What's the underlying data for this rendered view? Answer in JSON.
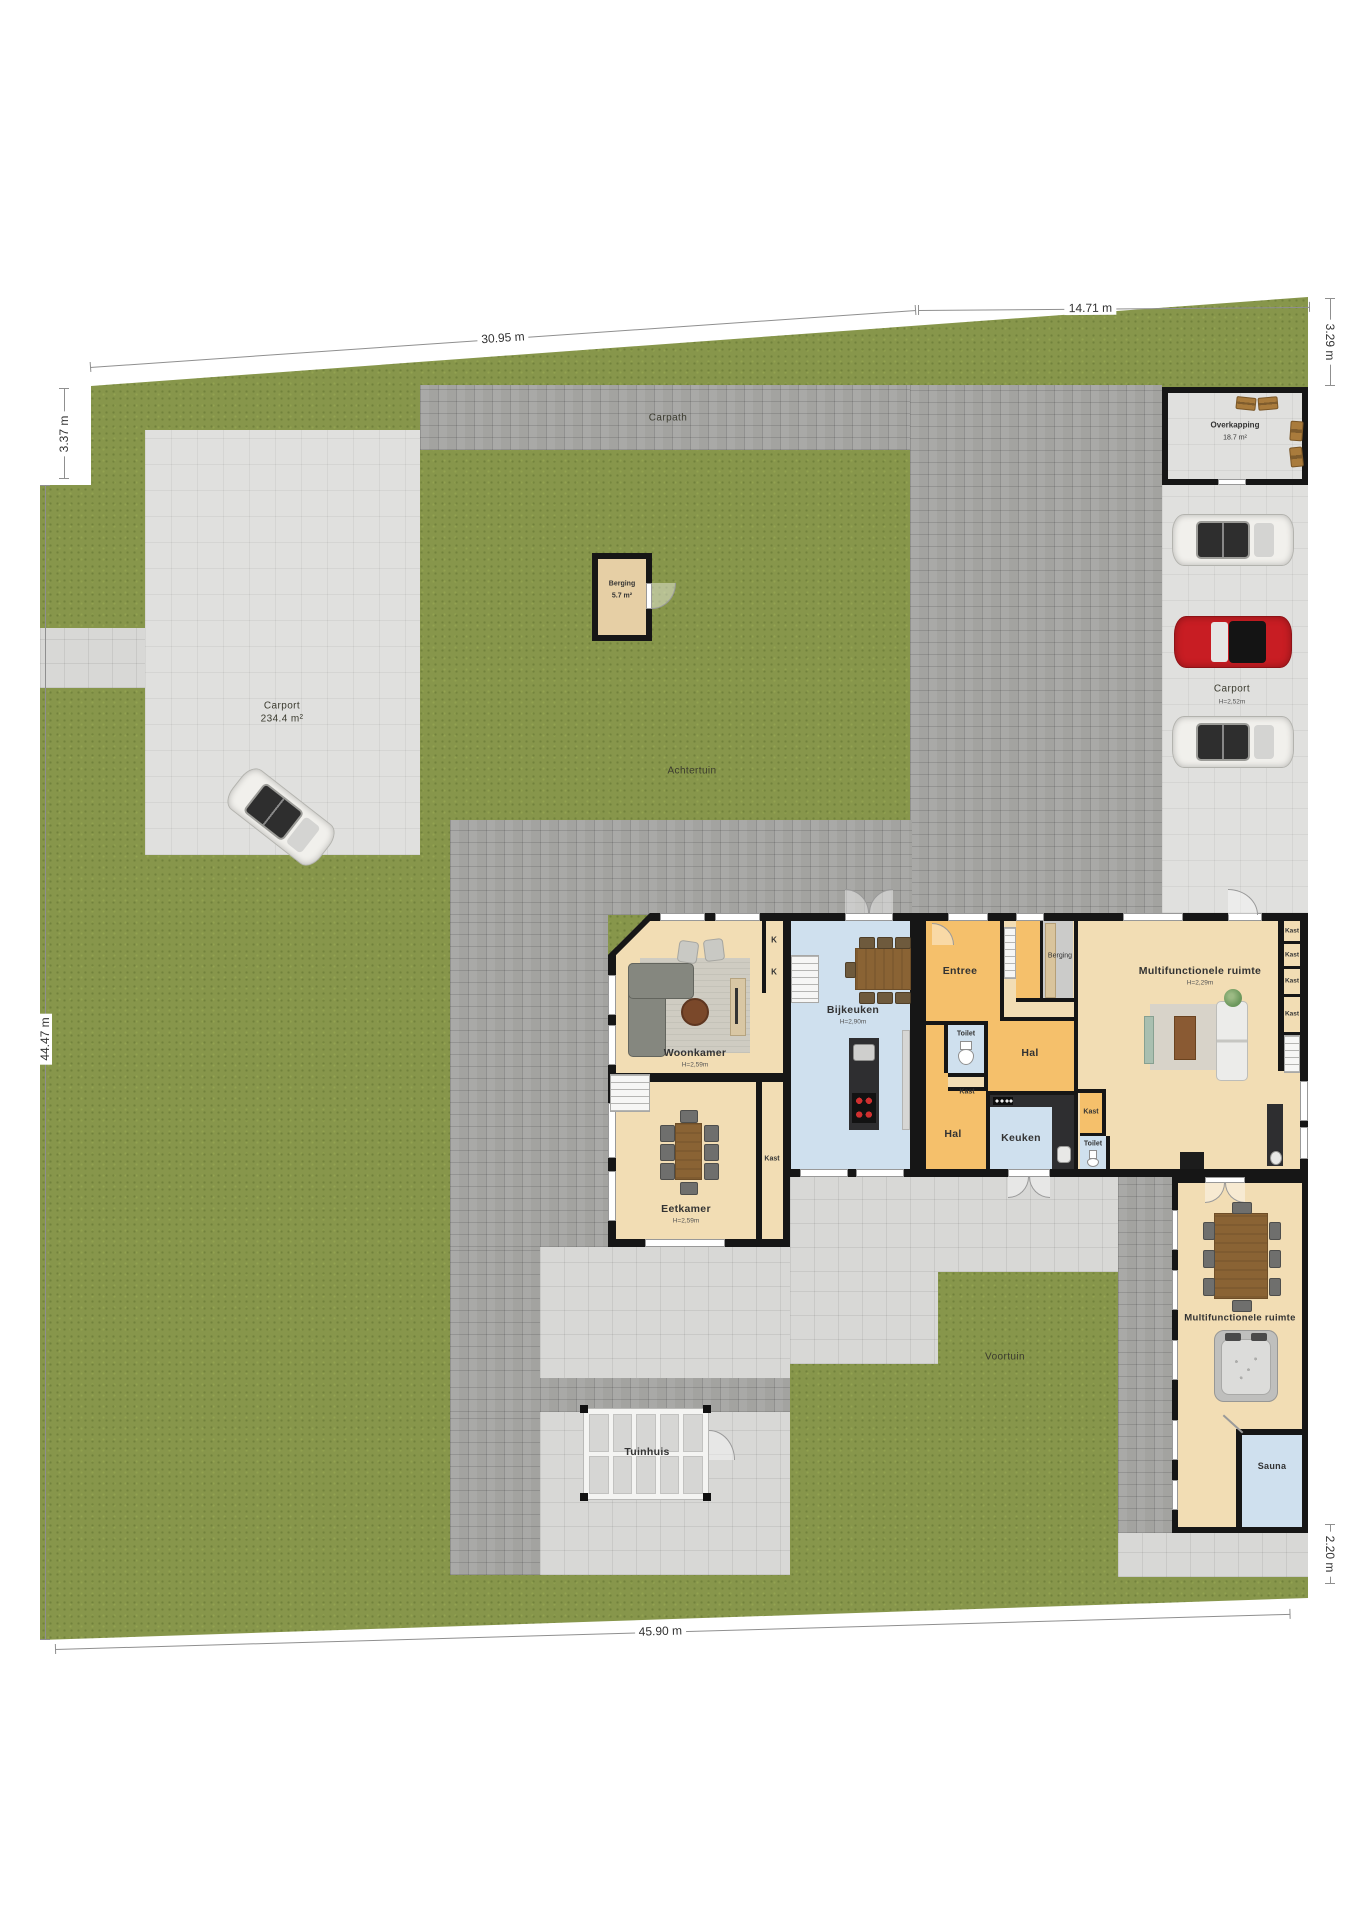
{
  "dimensions": {
    "top_left": "30.95 m",
    "top_right": "14.71 m",
    "left_upper": "3.37 m",
    "left_main": "44.47 m",
    "right_upper": "3.29 m",
    "right_lower": "2.20 m",
    "bottom": "45.90 m"
  },
  "site": {
    "carpath_label": "Carpath",
    "achtertuin_label": "Achtertuin",
    "voortuin_label": "Voortuin",
    "tuinhuis_label": "Tuinhuis",
    "carport_left": {
      "name": "Carport",
      "area": "234.4 m²"
    },
    "carport_right": {
      "name": "Carport",
      "height": "H=2,52m"
    },
    "overkapping": {
      "name": "Overkapping",
      "area": "18.7 m²"
    },
    "berging_shed": {
      "name": "Berging",
      "area": "5.7 m²"
    }
  },
  "rooms": {
    "woonkamer": {
      "name": "Woonkamer",
      "height": "H=2,59m"
    },
    "eetkamer": {
      "name": "Eetkamer",
      "height": "H=2,59m"
    },
    "bijkeuken": {
      "name": "Bijkeuken",
      "height": "H=2,90m"
    },
    "entree": {
      "name": "Entree"
    },
    "berging": {
      "name": "Berging"
    },
    "hal": {
      "name": "Hal"
    },
    "toilet": {
      "name": "Toilet"
    },
    "kast": {
      "name": "Kast"
    },
    "kast_short": "K",
    "keuken": {
      "name": "Keuken"
    },
    "multifunctioneel": {
      "name": "Multifunctionele ruimte",
      "height": "H=2,29m"
    },
    "multifunctioneel_wing": {
      "name": "Multifunctionele ruimte"
    },
    "sauna": {
      "name": "Sauna"
    }
  }
}
